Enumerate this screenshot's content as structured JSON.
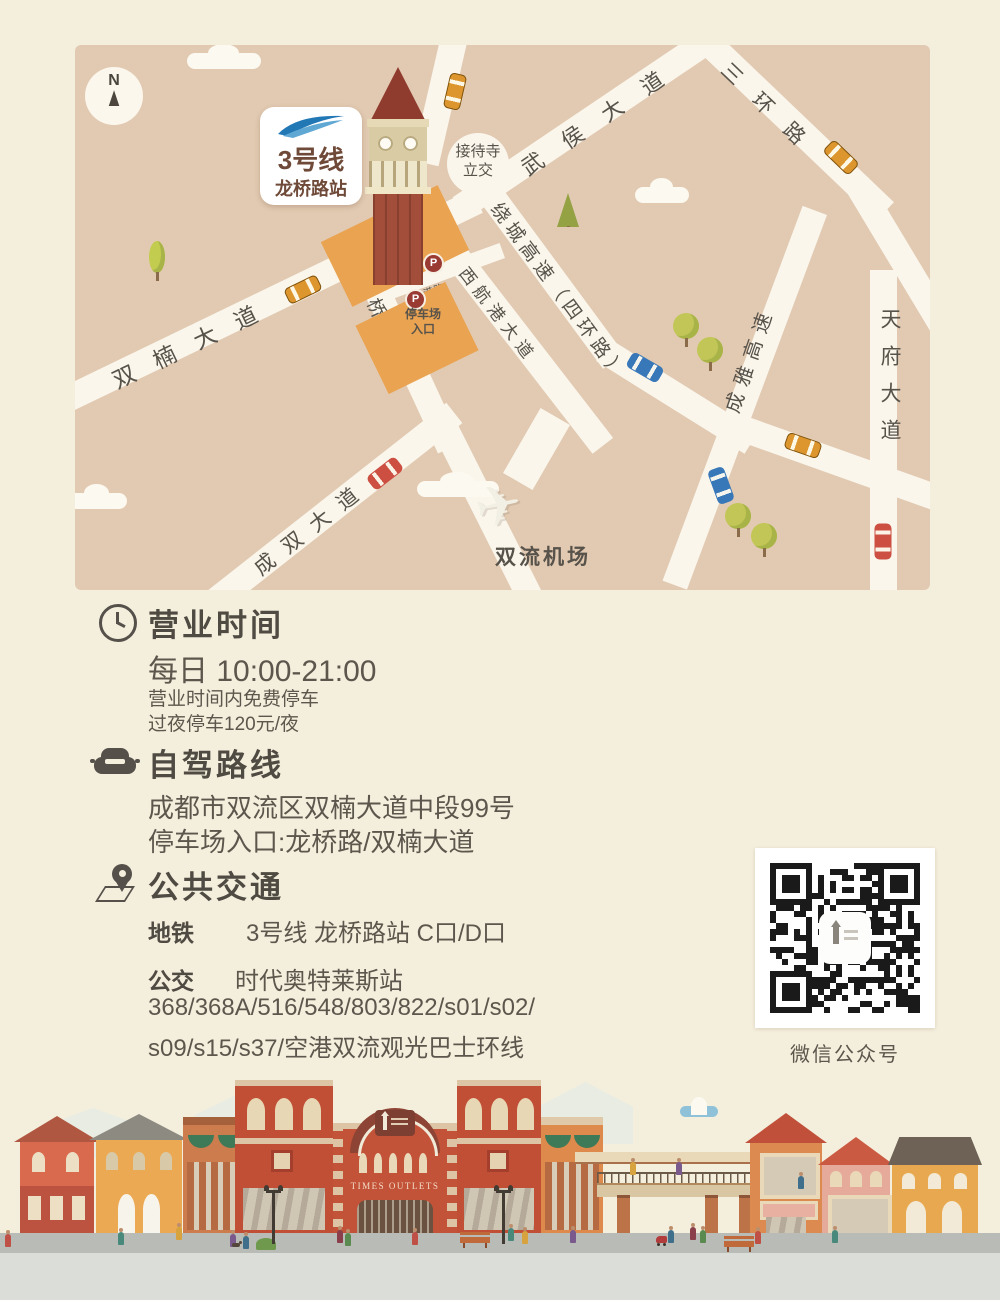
{
  "map": {
    "compass": "N",
    "metro_badge": {
      "line": "3号线",
      "station": "龙桥路站"
    },
    "roads": [
      {
        "id": "shuangnan",
        "label": "双楠大道"
      },
      {
        "id": "wuhou",
        "label": "武侯大道"
      },
      {
        "id": "sanhuan",
        "label": "三环路"
      },
      {
        "id": "raocheng",
        "label": "绕城高速（四环路）"
      },
      {
        "id": "chengya",
        "label": "成雅高速"
      },
      {
        "id": "tianfu",
        "label": "天府大道"
      },
      {
        "id": "xihanggang",
        "label": "西航港大道"
      },
      {
        "id": "longqiao",
        "label": "龙桥路"
      },
      {
        "id": "chengshuang",
        "label": "成双大道"
      },
      {
        "id": "hanggang",
        "label": "航港路"
      }
    ],
    "interchange": "接待寺\n立交",
    "airport": "双流机场",
    "parking_entrance": "停车场\n入口",
    "parking_symbol": "P",
    "plane_icon": "✈"
  },
  "sections": {
    "hours": {
      "title": "营业时间",
      "time": "每日 10:00-21:00",
      "note1": "营业时间内免费停车",
      "note2": "过夜停车120元/夜"
    },
    "driving": {
      "title": "自驾路线",
      "address": "成都市双流区双楠大道中段99号",
      "entrance": "停车场入口:龙桥路/双楠大道"
    },
    "transit": {
      "title": "公共交通",
      "metro_label": "地铁",
      "metro_value": "3号线 龙桥路站 C口/D口",
      "bus_label": "公交",
      "bus_stop": "时代奥特莱斯站",
      "bus_lines1": "368/368A/516/548/803/822/s01/s02/",
      "bus_lines2": "s09/s15/s37/空港双流观光巴士环线"
    }
  },
  "qr": {
    "caption": "微信公众号"
  },
  "footer": {
    "building_sign": "TIMES OUTLETS"
  },
  "colors": {
    "page_bg": "#f4efdd",
    "map_bg": "#e2cab2",
    "road": "#faf6ec",
    "parking_block": "#e9a351",
    "metro_blue": "#2277b5",
    "text_dark": "#4f4a42",
    "text_body": "#5c564c",
    "qr_black": "#1a1a1a"
  }
}
